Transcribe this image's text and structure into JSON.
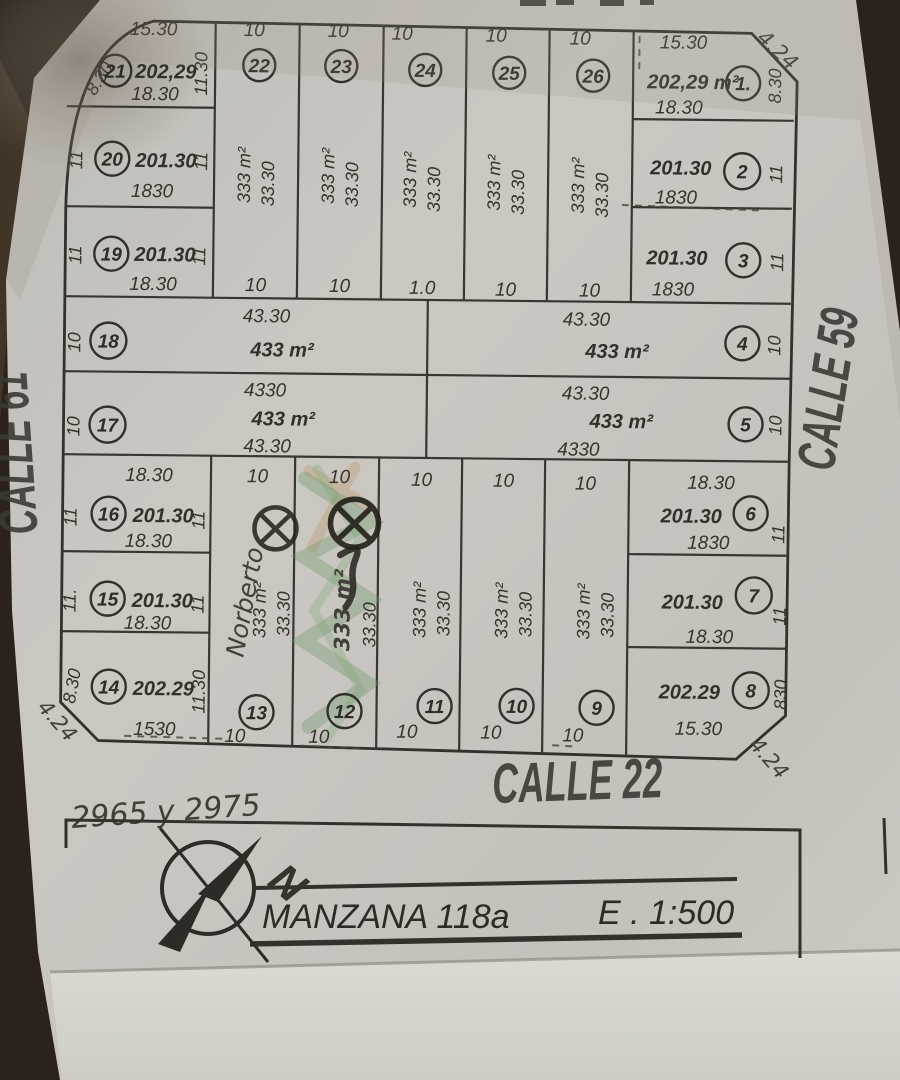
{
  "streets": {
    "left": "CALLE 61",
    "right": "CALLE 59",
    "bottom": "CALLE 22"
  },
  "title_block": {
    "block_name": "MANZANA 118a",
    "scale": "E . 1:500",
    "north": "N"
  },
  "handwritten": {
    "address": "2965 y 2975",
    "owner": "Norberto"
  },
  "corners": {
    "top_right": "4.24",
    "bottom_left": "4.24",
    "bottom_right": "4.24"
  },
  "colors": {
    "paper": "#d3d0cb",
    "background": "#2c241c",
    "ink": "#3a3833",
    "highlight_green": "#6f9f6d",
    "highlight_tan": "#c29356"
  },
  "lots": {
    "1": {
      "num": "1.",
      "area": "202,29 m²",
      "top": "15.30",
      "bottom": "18.30",
      "side": "8.30"
    },
    "2": {
      "num": "2",
      "area": "201.30",
      "bottom": "1830",
      "side": "11"
    },
    "3": {
      "num": "3",
      "area": "201.30",
      "bottom": "1830",
      "side": "11"
    },
    "4": {
      "num": "4",
      "area": "433 m²",
      "top": "43.30",
      "side": "10"
    },
    "5": {
      "num": "5",
      "area": "433 m²",
      "top": "43.30",
      "bottom": "4330",
      "side": "10"
    },
    "6": {
      "num": "6",
      "area": "201.30",
      "top": "18.30",
      "bottom": "1830",
      "side": "11"
    },
    "7": {
      "num": "7",
      "area": "201.30",
      "bottom": "18.30",
      "side": "11"
    },
    "8": {
      "num": "8",
      "area": "202.29",
      "bottom": "15.30",
      "side": "830"
    },
    "9": {
      "num": "9",
      "area": "333 m²",
      "depth": "33.30",
      "top": "10",
      "bottom": "10"
    },
    "10": {
      "num": "10",
      "area": "333 m²",
      "depth": "33.30",
      "top": "10",
      "bottom": "10"
    },
    "11": {
      "num": "11",
      "area": "333 m²",
      "depth": "33.30",
      "top": "10",
      "bottom": "10"
    },
    "12": {
      "num": "12",
      "area": "333 m²",
      "depth": "33.30",
      "top": "10",
      "bottom": "10"
    },
    "13": {
      "num": "13",
      "area": "333 m²",
      "depth": "33.30",
      "top": "10",
      "bottom": "10"
    },
    "14": {
      "num": "14",
      "area": "202.29",
      "bottom": "1530",
      "left": "8.30",
      "right": "11.30"
    },
    "15": {
      "num": "15",
      "area": "201.30",
      "bottom": "18.30",
      "left": "11.",
      "right": "11"
    },
    "16": {
      "num": "16",
      "area": "201.30",
      "top": "18.30",
      "bottom": "18.30",
      "left": "11",
      "right": "11"
    },
    "17": {
      "num": "17",
      "area": "433 m²",
      "top": "4330",
      "bottom": "43.30",
      "side": "10"
    },
    "18": {
      "num": "18",
      "area": "433 m²",
      "top": "43.30",
      "side": "10"
    },
    "19": {
      "num": "19",
      "area": "201.30",
      "bottom": "18.30",
      "left": "11",
      "right": "11"
    },
    "20": {
      "num": "20",
      "area": "201.30",
      "bottom": "1830",
      "left": "11",
      "right": "11"
    },
    "21": {
      "num": "21",
      "area": "202,29",
      "top": "15.30",
      "bottom": "18.30",
      "left": "8.30",
      "right": "11.30"
    },
    "22": {
      "num": "22",
      "area": "333 m²",
      "depth": "33.30",
      "top": "10",
      "bottom": "10"
    },
    "23": {
      "num": "23",
      "area": "333 m²",
      "depth": "33.30",
      "top": "10",
      "bottom": "10"
    },
    "24": {
      "num": "24",
      "area": "333 m²",
      "depth": "33.30",
      "top": "10",
      "bottom": "1.0"
    },
    "25": {
      "num": "25",
      "area": "333 m²",
      "depth": "33.30",
      "top": "10",
      "bottom": "10"
    },
    "26": {
      "num": "26",
      "area": "333 m²",
      "depth": "33.30",
      "top": "10",
      "bottom": "10"
    }
  }
}
